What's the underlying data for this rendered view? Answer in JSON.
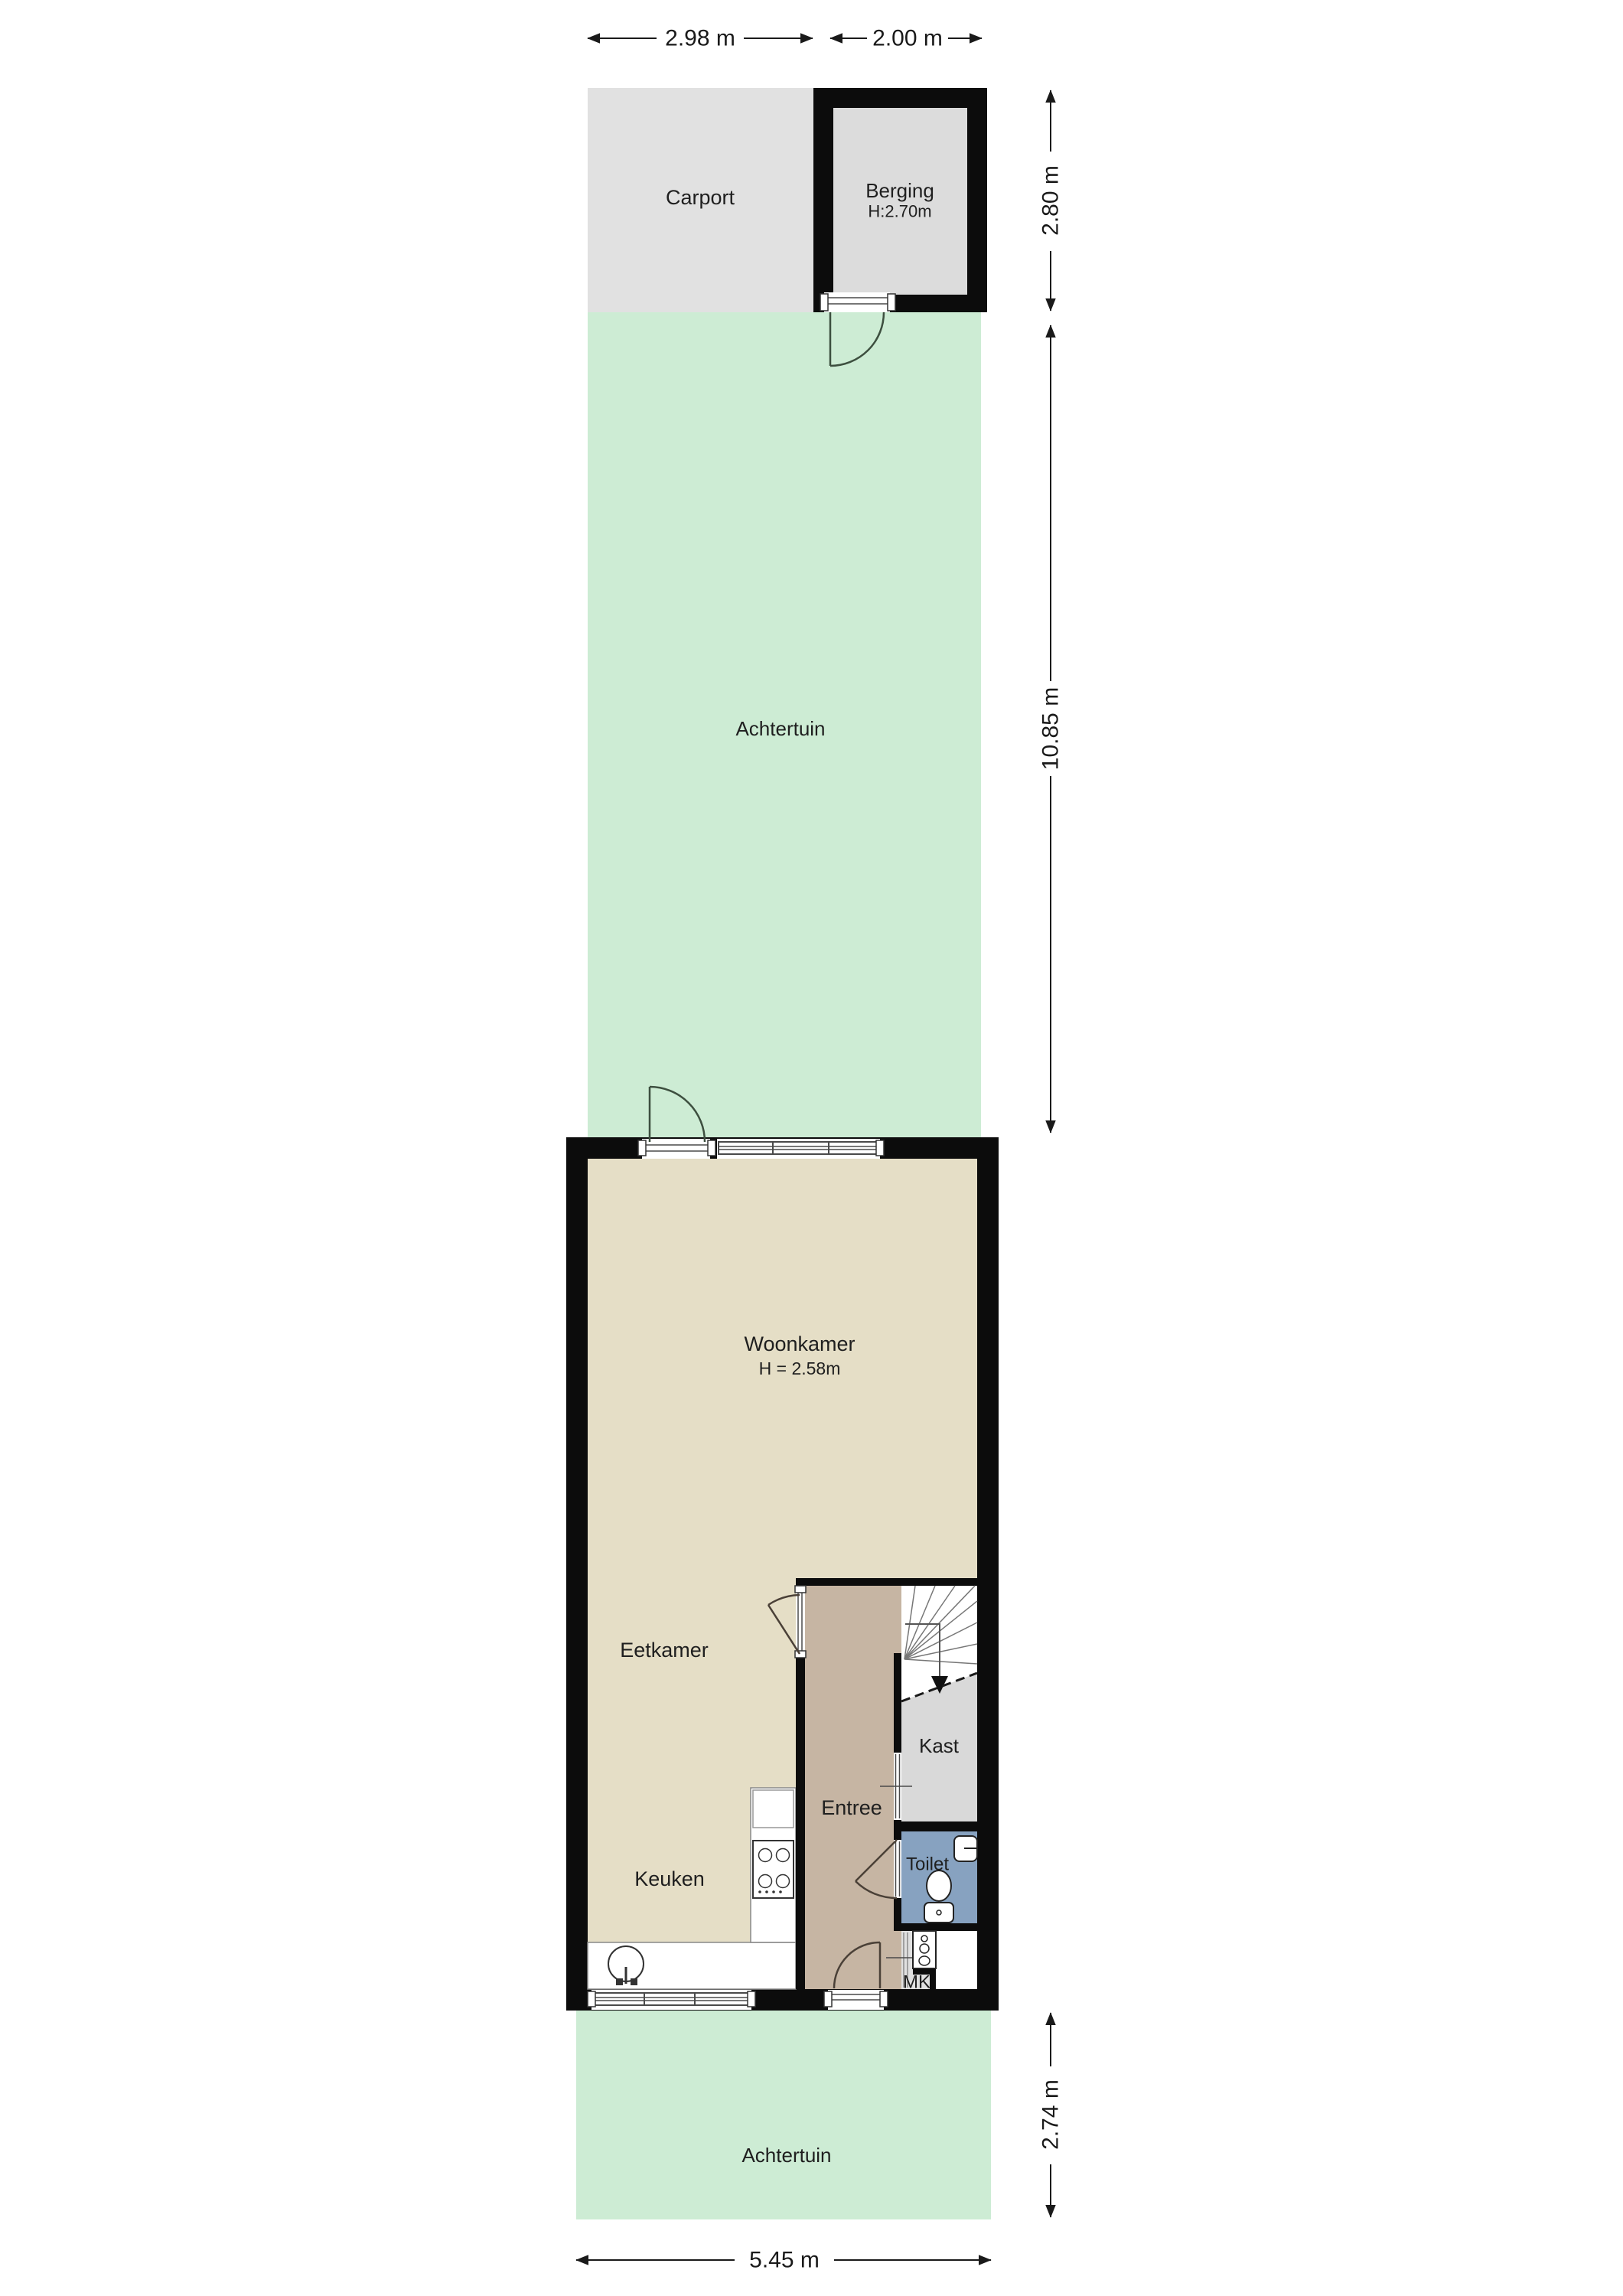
{
  "floorplan": {
    "rooms": {
      "carport": {
        "label": "Carport"
      },
      "berging": {
        "label": "Berging",
        "height": "H:2.70m"
      },
      "achtertuin_top": {
        "label": "Achtertuin"
      },
      "woonkamer": {
        "label": "Woonkamer",
        "height": "H = 2.58m"
      },
      "eetkamer": {
        "label": "Eetkamer"
      },
      "keuken": {
        "label": "Keuken"
      },
      "entree": {
        "label": "Entree"
      },
      "kast": {
        "label": "Kast"
      },
      "toilet": {
        "label": "Toilet"
      },
      "mk": {
        "label": "MK"
      },
      "achtertuin_bottom": {
        "label": "Achtertuin"
      }
    },
    "dimensions": {
      "carport_width": "2.98 m",
      "berging_width": "2.00 m",
      "carport_depth": "2.80 m",
      "garden_depth": "10.85 m",
      "front_garden_depth": "2.74 m",
      "plot_width": "5.45 m"
    },
    "colors": {
      "wall": "#0c0c0c",
      "living_floor": "#e5dec6",
      "entree_floor": "#c6b5a3",
      "kast_floor": "#d9d9d9",
      "toilet_floor": "#87a2c0",
      "garden": "#cdecd4",
      "carport": "#e1e1e1",
      "berging_floor": "#dcdcdc",
      "counter": "#ffffff"
    }
  }
}
